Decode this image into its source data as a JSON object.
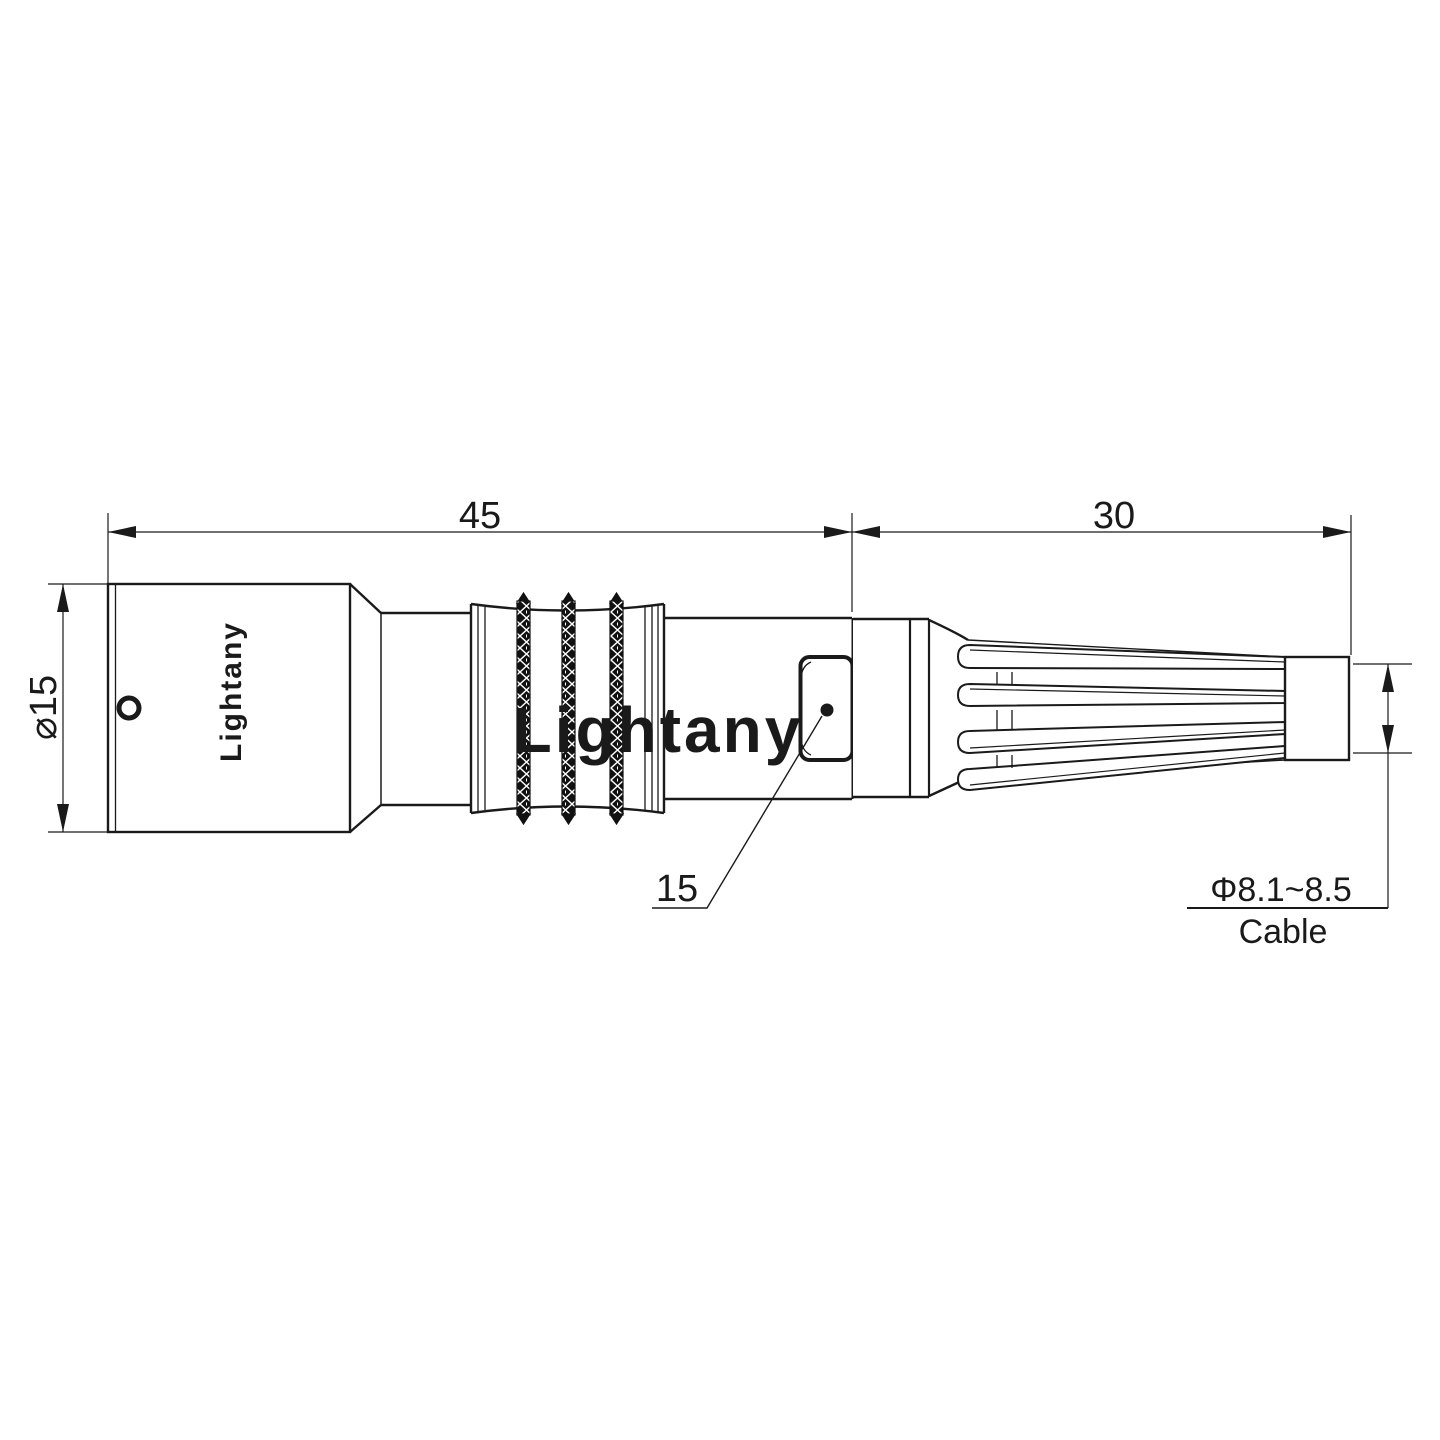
{
  "drawing": {
    "title": "connector-dimension-drawing",
    "body_label": "Lightany",
    "watermark_text": "Lightany",
    "dimensions": {
      "front_length": "45",
      "rear_length": "30",
      "body_diameter": "⌀15",
      "latch_size": "15",
      "cable_diameter_range": "Φ8.1~8.5",
      "cable_caption": "Cable"
    },
    "colors": {
      "line": "#1a1a1a",
      "background": "#ffffff",
      "watermark": "rgba(200,40,40,0.2)"
    }
  }
}
